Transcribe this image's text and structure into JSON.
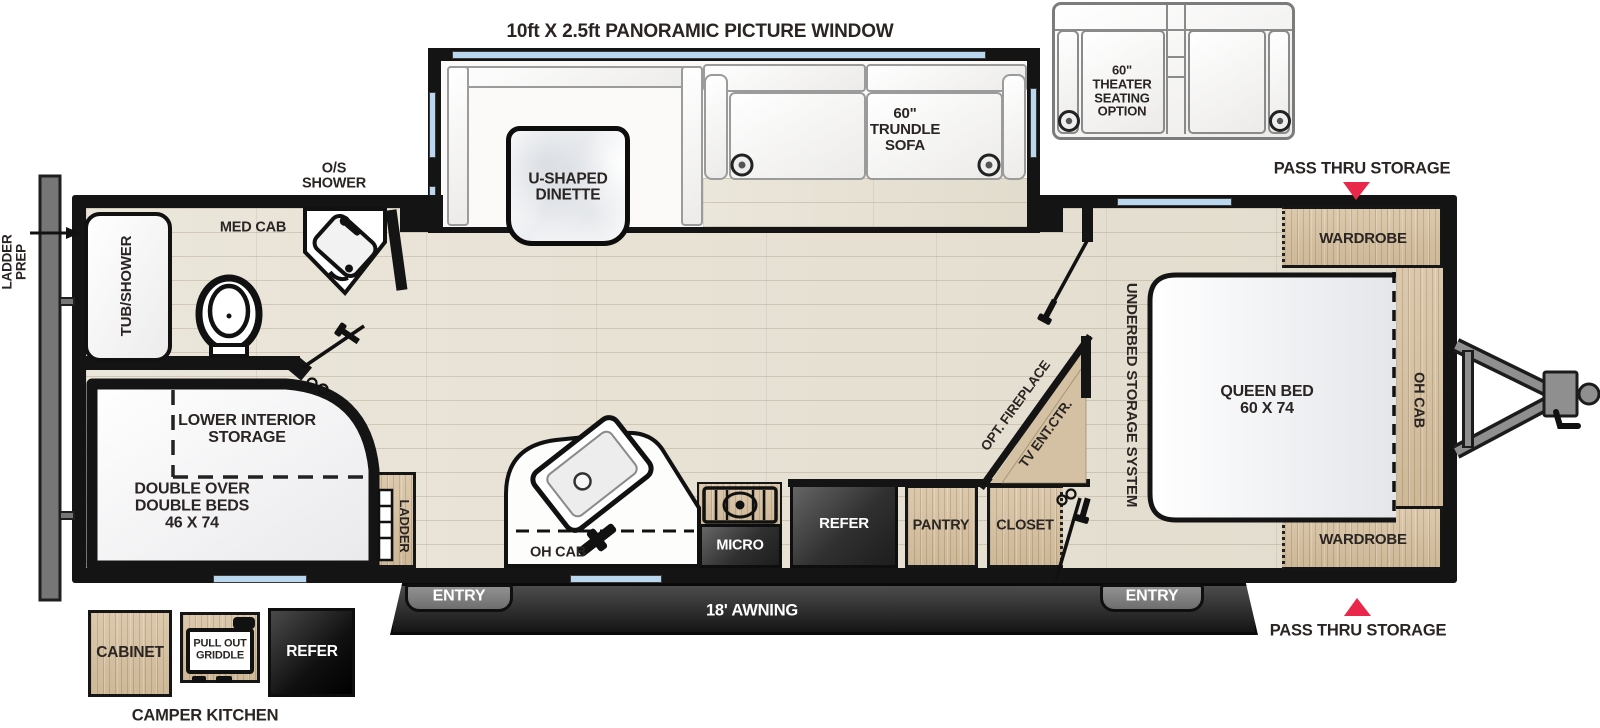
{
  "title": {
    "panoramic_window": "10ft X 2.5ft PANORAMIC PICTURE WINDOW"
  },
  "slide_out": {
    "dinette": "U-SHAPED\nDINETTE",
    "trundle_sofa": "60\"\nTRUNDLE\nSOFA"
  },
  "theater_option": {
    "label": "60\"\nTHEATER\nSEATING\nOPTION"
  },
  "pass_thru": {
    "top": "PASS THRU STORAGE",
    "bottom": "PASS THRU STORAGE"
  },
  "exterior": {
    "ladder_prep": "LADDER\nPREP",
    "awning": "18' AWNING",
    "entry_left": "ENTRY",
    "entry_right": "ENTRY"
  },
  "camper_kitchen": {
    "title": "CAMPER KITCHEN",
    "cabinet": "CABINET",
    "griddle": "PULL OUT\nGRIDDLE",
    "refer": "REFER"
  },
  "bathroom": {
    "tub_shower": "TUB/SHOWER",
    "med_cab": "MED CAB",
    "os_shower": "O/S\nSHOWER"
  },
  "bunk_room": {
    "lower_storage": "LOWER INTERIOR\nSTORAGE",
    "beds": "DOUBLE OVER\nDOUBLE BEDS\n46 X 74",
    "ladder": "LADDER"
  },
  "kitchen": {
    "oh_cab": "OH CAB",
    "micro": "MICRO",
    "refer": "REFER",
    "pantry": "PANTRY"
  },
  "bedroom": {
    "closet": "CLOSET",
    "opt_fireplace": "OPT. FIREPLACE",
    "tv_ent_ctr": "TV ENT.CTR.",
    "underbed": "UNDERBED STORAGE SYSTEM",
    "queen_bed": "QUEEN BED\n60 X 74",
    "wardrobe_top": "WARDROBE",
    "wardrobe_bottom": "WARDROBE",
    "oh_cab": "OH CAB"
  },
  "colors": {
    "accent_red": "#e8274b",
    "window_blue": "#b9d7ee",
    "wood": "#d6c3a6",
    "wall": "#141414"
  }
}
